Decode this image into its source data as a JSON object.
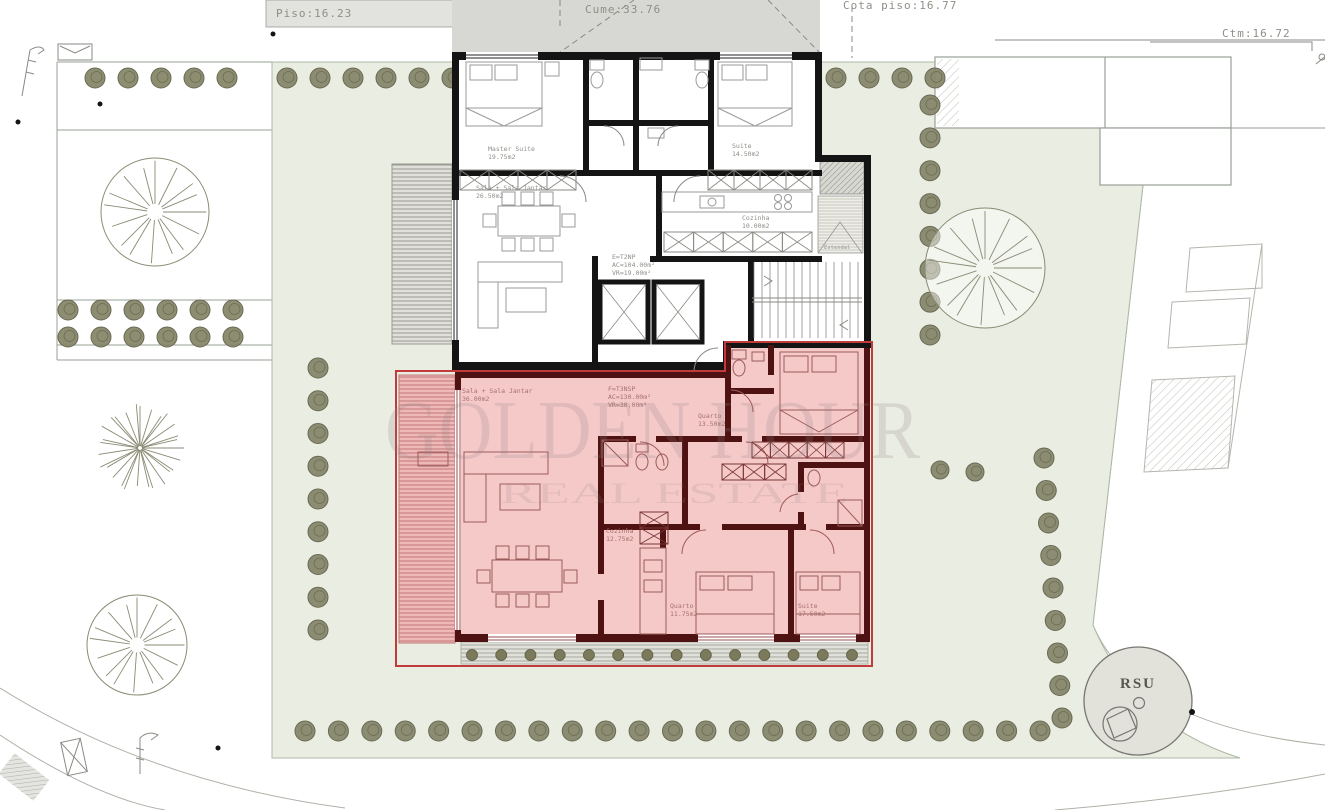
{
  "plan": {
    "annotations": {
      "piso": "Piso:16.23",
      "cume": "Cume:33.76",
      "cota_piso": "Cota piso:16.77",
      "ctm": "Ctm:16.72"
    },
    "watermark": {
      "line1": "GOLDEN HOUR",
      "line2": "REAL ESTATE"
    },
    "rsu_label": "RSU",
    "unit_e": {
      "code": "E=T2NP",
      "ac": "AC=104.00m²",
      "vr": "VR=19.00m²",
      "rooms": {
        "master_suite": {
          "name": "Master Suite",
          "area": "19.75m2"
        },
        "suite": {
          "name": "Suite",
          "area": "14.50m2"
        },
        "cozinha": {
          "name": "Cozinha",
          "area": "10.00m2"
        },
        "sala": {
          "name": "Sala + Sala Jantar",
          "area": "26.50m2"
        },
        "estendal": {
          "name": "Estendal"
        }
      }
    },
    "unit_f": {
      "code": "F=T3NSP",
      "ac": "AC=130.00m²",
      "vr": "VR=30.00m²",
      "rooms": {
        "sala": {
          "name": "Sala + Sala Jantar",
          "area": "36.00m2"
        },
        "cozinha": {
          "name": "Cozinha",
          "area": "12.75m2"
        },
        "quarto_1": {
          "name": "Quarto",
          "area": "13.50m2"
        },
        "quarto_2": {
          "name": "Quarto",
          "area": "11.75m2"
        },
        "suite": {
          "name": "Suite",
          "area": "17.50m2"
        }
      }
    },
    "colors": {
      "highlight_fill": "#f6c9c9",
      "highlight_wall": "#4f1212",
      "highlight_outline": "#c23b3b",
      "garden": "#e9ede2",
      "tree": "#87876b",
      "wall": "#141414",
      "roof": "#d7d7d4"
    }
  }
}
